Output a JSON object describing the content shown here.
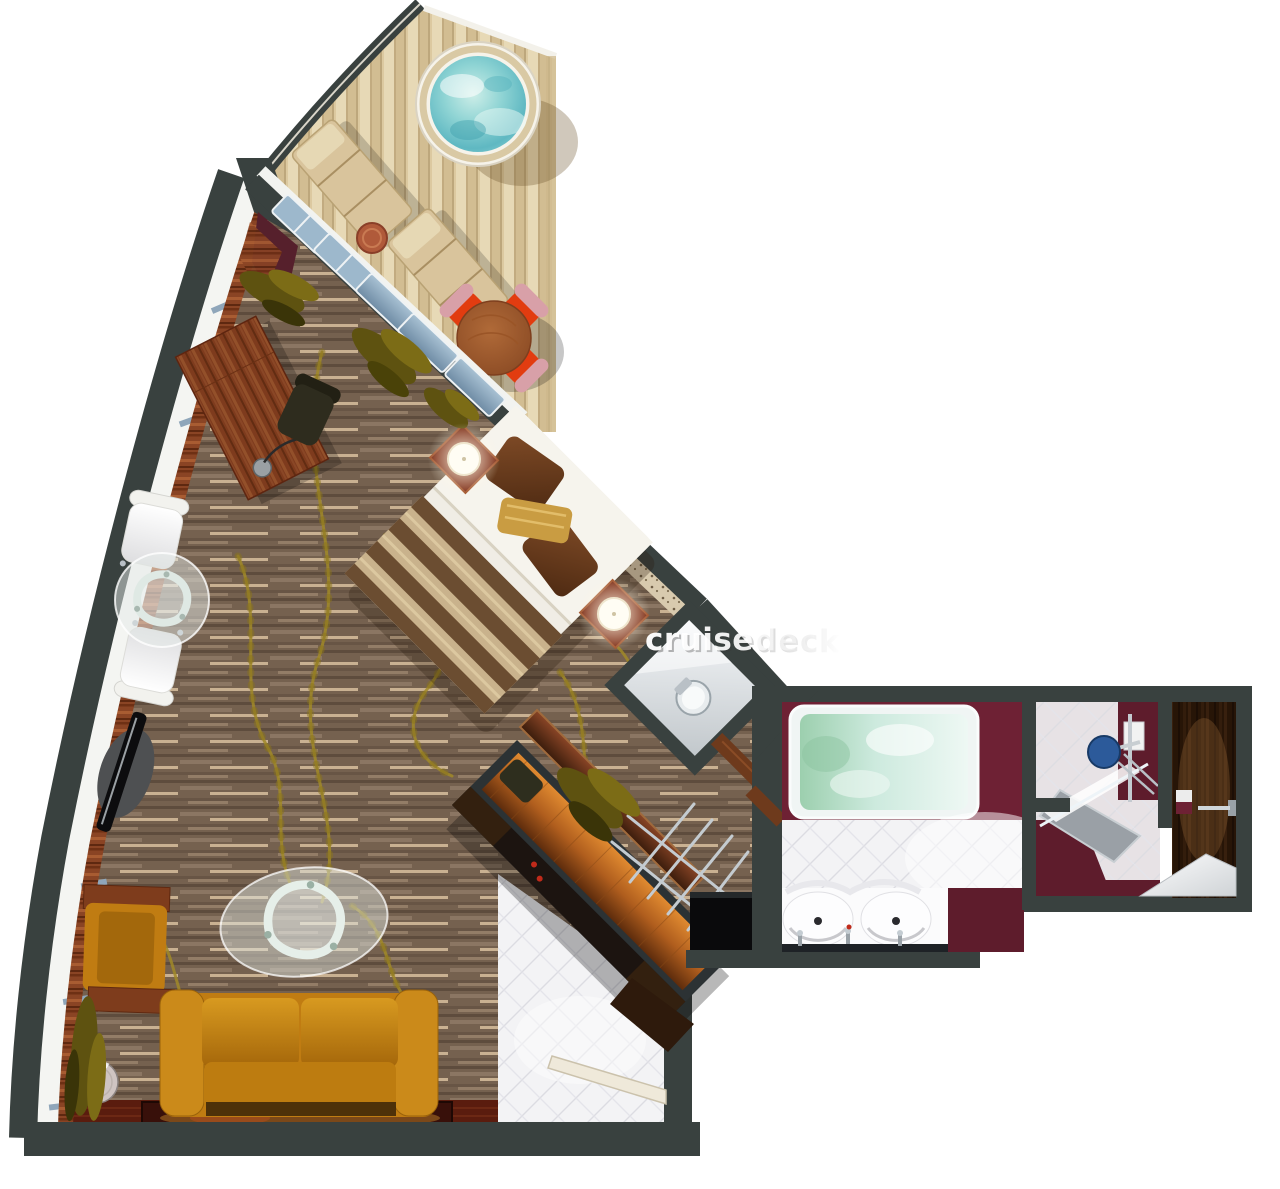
{
  "watermark": {
    "text": "cruisedeck"
  },
  "palette": {
    "background": "#ffffff",
    "wall": "#39413f",
    "carpet": "#75614f",
    "vine": "#a18a28",
    "deck": "#dcc9a0",
    "accent": "#6e2134",
    "tile": "#f3f3f5",
    "sofa": "#c07c12",
    "linen": "#f0ede5",
    "blanket": "#6b4d31",
    "chairRed": "#e23c10",
    "chairPink": "#d8a0a8",
    "hotTubWater": "#7ecfd4",
    "tubWater": "#a8d8c0",
    "darkWood": "#2a1709",
    "deskWood": "#7e3b1d",
    "showerBlue": "#2c5a9a",
    "rug": "#38100a",
    "lampGlow": "#fff8e6",
    "railing": "#f3f1ea",
    "sillWood": "#8a4424"
  },
  "rooms": {
    "items": [
      "balcony",
      "living-bedroom",
      "toilet",
      "bathroom",
      "shower",
      "vestibule",
      "entry-hall"
    ]
  },
  "furniture": {
    "items": [
      "hot-tub",
      "sun-lounger",
      "balcony-dining-set",
      "desk",
      "desk-chair",
      "tv",
      "lounge-chairs",
      "glass-table",
      "double-bed",
      "nightstand-lamps",
      "wardrobe",
      "luggage-rack",
      "minibar-cabinet",
      "armchair",
      "sofa",
      "coffee-table",
      "side-table",
      "rug",
      "whirlpool-bath",
      "double-vanity",
      "shower-unit",
      "toilet",
      "entry-door"
    ]
  }
}
